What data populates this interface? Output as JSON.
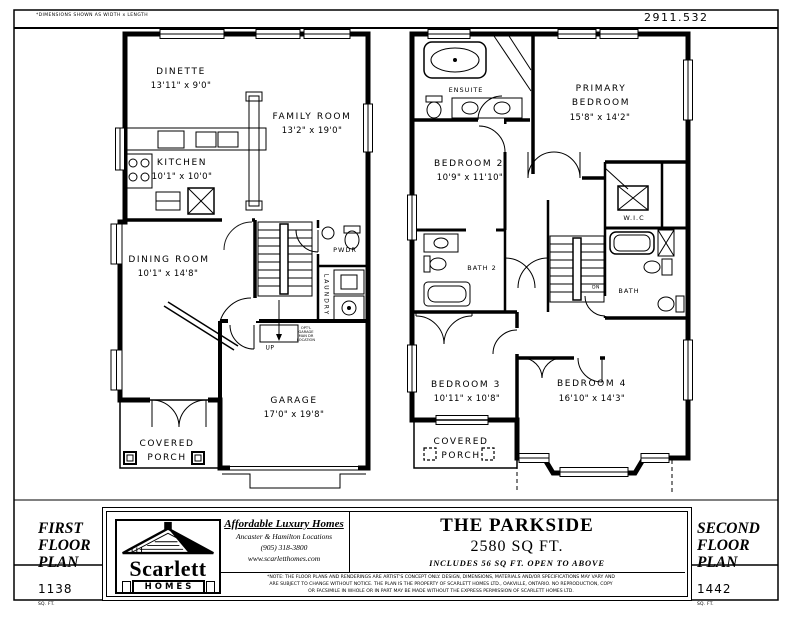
{
  "page": {
    "dims_note": "*DIMENSIONS SHOWN AS WIDTH x LENGTH",
    "plan_number": "2911.532"
  },
  "first_floor": {
    "plan_title": "FIRST\nFLOOR\nPLAN",
    "area": "1138",
    "area_unit": "SQ. FT.",
    "rooms": {
      "dinette": {
        "name": "DINETTE",
        "dims": "13'11\" x 9'0\""
      },
      "family": {
        "name": "FAMILY ROOM",
        "dims": "13'2\" x 19'0\""
      },
      "kitchen": {
        "name": "KITCHEN",
        "dims": "10'1\" x 10'0\""
      },
      "dining": {
        "name": "DINING ROOM",
        "dims": "10'1\" x 14'8\""
      },
      "powder": {
        "name": "PWDR"
      },
      "laundry": {
        "name": "LAUNDRY"
      },
      "garage": {
        "name": "GARAGE",
        "dims": "17'0\" x 19'8\""
      },
      "porch": {
        "name": "COVERED\nPORCH"
      }
    },
    "stair_label": "UP",
    "opt_door_note": "OPT'L\nGARAGE\nMAN DR\nLOCATION"
  },
  "second_floor": {
    "plan_title": "SECOND\nFLOOR\nPLAN",
    "area": "1442",
    "area_unit": "SQ. FT.",
    "rooms": {
      "ensuite": {
        "name": "ENSUITE"
      },
      "primary": {
        "name": "PRIMARY\nBEDROOM",
        "dims": "15'8\" x 14'2\""
      },
      "bedroom2": {
        "name": "BEDROOM 2",
        "dims": "10'9\" x 11'10\""
      },
      "wic": {
        "name": "W.I.C"
      },
      "bath2": {
        "name": "BATH 2"
      },
      "bath": {
        "name": "BATH"
      },
      "bedroom3": {
        "name": "BEDROOM 3",
        "dims": "10'11\" x 10'8\""
      },
      "bedroom4": {
        "name": "BEDROOM 4",
        "dims": "16'10\" x 14'3\""
      },
      "porch": {
        "name": "COVERED\nPORCH"
      }
    },
    "stair_label": "DN"
  },
  "title_block": {
    "builder": {
      "logo_name": "Scarlett",
      "logo_sub": "HOMES",
      "tagline": "Affordable Luxury Homes",
      "locations": "Ancaster & Hamilton Locations",
      "phone": "(905) 318-3800",
      "website": "www.scarletthomes.com"
    },
    "model": {
      "name": "THE PARKSIDE",
      "area": "2580 SQ FT.",
      "note": "INCLUDES 56 SQ FT. OPEN TO ABOVE"
    },
    "disclaimer": "*NOTE: THE FLOOR PLANS AND RENDERINGS ARE ARTIST'S CONCEPT ONLY. DESIGN, DIMENSIONS, MATERIALS AND/OR SPECIFICATIONS MAY VARY AND ARE SUBJECT TO CHANGE WITHOUT NOTICE. THE PLAN IS THE PROPERTY OF SCARLETT HOMES LTD., OAKVILLE, ONTARIO. NO REPRODUCTION, COPY OR FACSIMILE IN WHOLE OR IN PART MAY BE MADE WITHOUT THE EXPRESS PERMISSION OF SCARLETT HOMES LTD."
  }
}
